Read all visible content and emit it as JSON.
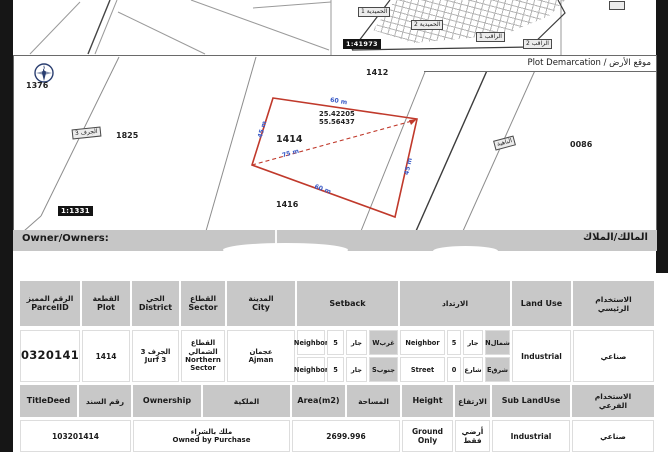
{
  "colors": {
    "plot_outline": "#c0392b",
    "dimension_text": "#3a5bc7",
    "header_bg": "#c8c8c8"
  },
  "top_maps": {
    "area_labels": [
      "الحميدية 1",
      "الحميدية 2",
      "الراقب 1",
      "الراقب 2"
    ],
    "scale": "1:41973"
  },
  "demarcation": {
    "title": "موقع الأرض / Plot Demarcation",
    "compass": "N",
    "scale": "1:1331",
    "parcel_labels": {
      "p1376": "1376",
      "p1825": "1825",
      "p1414": "1414",
      "p1416": "1416",
      "p1412": "1412",
      "p0086": "0086"
    },
    "road_labels": {
      "jurf3": "الجرف 3",
      "bahia": "الباهية"
    },
    "plot": {
      "number": "1414",
      "latitude": "25.42205",
      "longitude": "55.56437",
      "dim_top": "60 m",
      "dim_bottom": "60 m",
      "dim_left": "45 m",
      "dim_right": "45 m",
      "dim_diagonal": "75 m"
    }
  },
  "owner_bar": {
    "label_en": "Owner/Owners:",
    "label_ar": "المالك/الملاك"
  },
  "table1": {
    "headers": {
      "parcel_id": {
        "ar": "الرقم المميز",
        "en": "ParcelID"
      },
      "plot": {
        "ar": "القطعة",
        "en": "Plot"
      },
      "district": {
        "ar": "الحي",
        "en": "District"
      },
      "sector": {
        "ar": "القطاع",
        "en": "Sector"
      },
      "city": {
        "ar": "المدينة",
        "en": "City"
      },
      "setback_en": "Setback",
      "setback_ar": "الارتداد",
      "land_use": "Land Use",
      "main_use_ar": "الاستخدام الرئيسي"
    },
    "row": {
      "parcel_id": "103201414",
      "plot": "1414",
      "district": {
        "ar": "الجرف 3",
        "en": "Jurf 3"
      },
      "sector": {
        "ar": "القطاع الشمالي",
        "en": "Northern Sector"
      },
      "city": {
        "ar": "عجمان",
        "en": "Ajman"
      },
      "setback": [
        {
          "type": "Neighbor",
          "value": "5",
          "type_ar": "جار",
          "direction": "غربW"
        },
        {
          "type": "Neighbor",
          "value": "5",
          "type_ar": "جار",
          "direction": "جنوبS"
        }
      ],
      "irtidad": [
        {
          "type": "Neighbor",
          "value": "5",
          "type_ar": "جار",
          "direction": "شمالN"
        },
        {
          "type": "Street",
          "value": "0",
          "type_ar": "شارع",
          "direction": "شرقE"
        }
      ],
      "land_use_en": "Industrial",
      "land_use_ar": "صناعي"
    }
  },
  "table2": {
    "headers": {
      "title_deed_en": "TitleDeed",
      "title_deed_ar": "رقم السند",
      "ownership_en": "Ownership",
      "ownership_ar": "الملكية",
      "area_en": "Area(m2)",
      "area_ar": "المساحة",
      "height_en": "Height",
      "height_ar": "الارتفاع",
      "sub_land_use_en": "Sub LandUse",
      "sub_land_use_ar": "الاستخدام الفرعي"
    },
    "row": {
      "title_deed": "103201414",
      "ownership_ar": "ملك بالشراء",
      "ownership_en": "Owned by Purchase",
      "area": "2699.996",
      "height_en": "Ground Only",
      "height_ar": "أرضي فقط",
      "sub_land_use_en": "Industrial",
      "sub_land_use_ar": "صناعي"
    }
  }
}
